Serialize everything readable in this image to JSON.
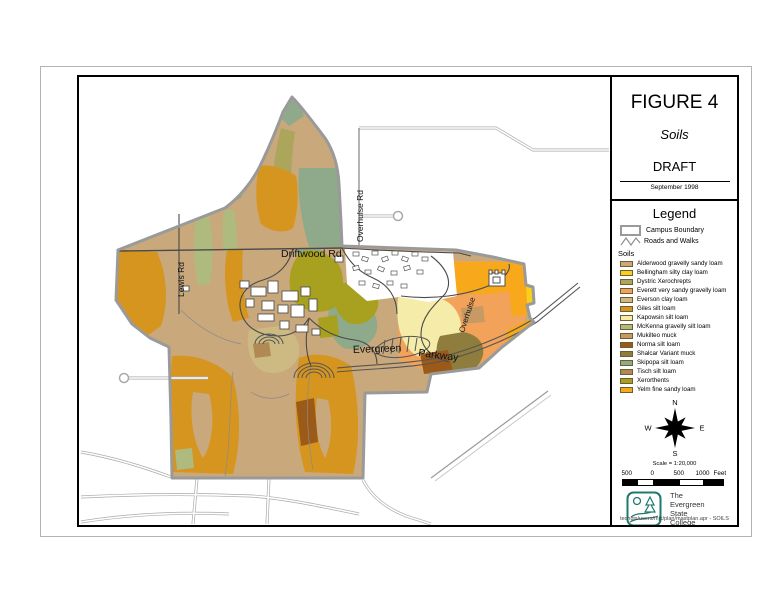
{
  "title_block": {
    "figure": "FIGURE 4",
    "subtitle": "Soils",
    "status": "DRAFT",
    "date": "September 1998"
  },
  "legend": {
    "title": "Legend",
    "campus_boundary": "Campus Boundary",
    "roads_walks": "Roads and Walks",
    "soils_heading": "Soils",
    "soils": [
      {
        "label": "Alderwood gravelly sandy loam",
        "color": "#C9A87C"
      },
      {
        "label": "Bellingham silty clay loam",
        "color": "#FACF1B"
      },
      {
        "label": "Dystric Xerochrepts",
        "color": "#ABA65C"
      },
      {
        "label": "Everett very sandy gravelly loam",
        "color": "#F2A359"
      },
      {
        "label": "Everson clay loam",
        "color": "#CDBA83"
      },
      {
        "label": "Giles silt loam",
        "color": "#D6951E"
      },
      {
        "label": "Kapowsin silt loam",
        "color": "#F5ECA9"
      },
      {
        "label": "McKenna gravelly silt loam",
        "color": "#AEBA7E"
      },
      {
        "label": "Mukilteo muck",
        "color": "#C69A62"
      },
      {
        "label": "Norma silt loam",
        "color": "#9C5A19"
      },
      {
        "label": "Shalcar Variant muck",
        "color": "#8F7D3E"
      },
      {
        "label": "Skipopa silt loam",
        "color": "#8FA98B"
      },
      {
        "label": "Tisch silt loam",
        "color": "#B08A52"
      },
      {
        "label": "Xerorthents",
        "color": "#A8A01F"
      },
      {
        "label": "Yelm fine sandy loam",
        "color": "#F7A81B"
      }
    ]
  },
  "compass": {
    "north": "N",
    "south": "S",
    "east": "E",
    "west": "W"
  },
  "scalebar": {
    "scale_text": "Scale = 1:20,000",
    "labels": [
      "500",
      "0",
      "500",
      "1000"
    ],
    "unit": "Feet"
  },
  "logo": {
    "name_lines": [
      "The",
      "Evergreen",
      "State",
      "College"
    ],
    "accent_color": "#1E7A6E"
  },
  "map": {
    "labels": {
      "driftwood": "Driftwood Rd",
      "overhulse_vertical": "Overhulse Rd",
      "lewis": "Lewis Rd",
      "overhulse_diagonal": "Overhulse",
      "evergreen": "Evergreen",
      "parkway": "Parkway"
    }
  },
  "footer": {
    "path_text": "techgis/users/mjk/plan/mastplan.apr - SOILS"
  }
}
